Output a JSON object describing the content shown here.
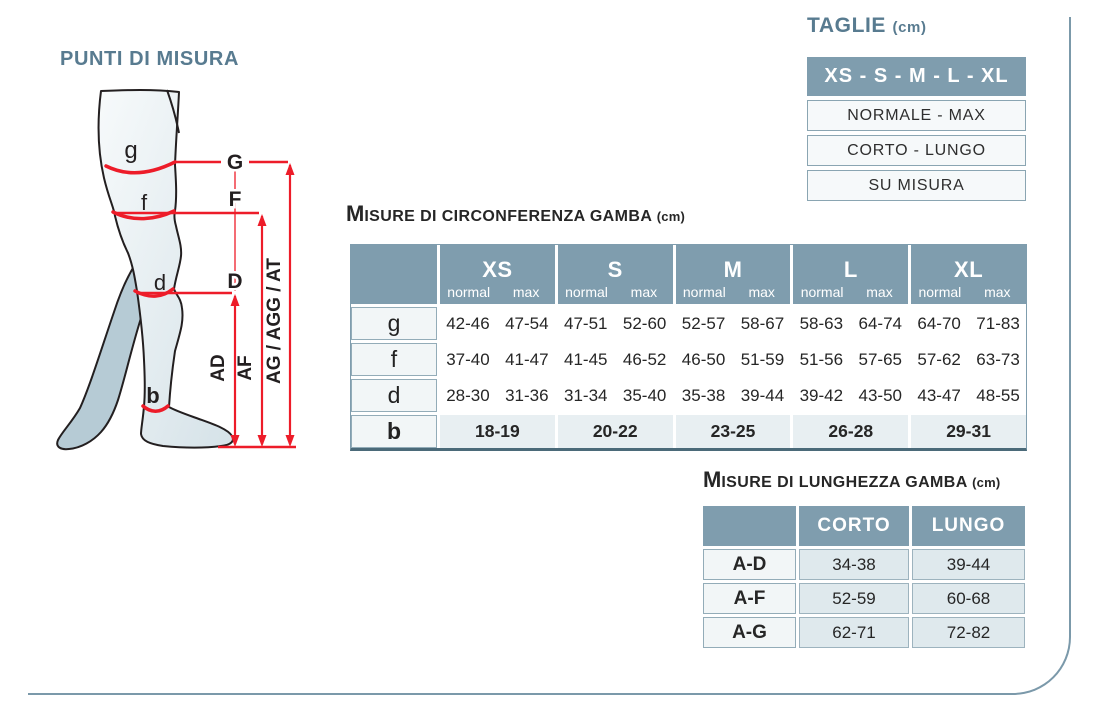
{
  "measure_points": {
    "title": "PUNTI DI MISURA",
    "points": {
      "g": "g",
      "f": "f",
      "d": "d",
      "b": "b"
    },
    "lines": {
      "G": "G",
      "F": "F",
      "D": "D"
    },
    "arrows": {
      "ad": "AD",
      "af": "AF",
      "ag": "AG / AGG / AT"
    }
  },
  "taglie": {
    "title": "TAGLIE",
    "title_unit": "(cm)",
    "sizes_header": "XS - S - M - L - XL",
    "options": [
      "NORMALE - MAX",
      "CORTO - LUNGO",
      "SU MISURA"
    ]
  },
  "circumference": {
    "title_initial": "M",
    "title_rest": "isure di circonferenza gamba",
    "title_unit": "(cm)",
    "sizes": [
      "XS",
      "S",
      "M",
      "L",
      "XL"
    ],
    "subcols": [
      "normal",
      "max"
    ],
    "rows": [
      {
        "label": "g",
        "values": [
          "42-46",
          "47-54",
          "47-51",
          "52-60",
          "52-57",
          "58-67",
          "58-63",
          "64-74",
          "64-70",
          "71-83"
        ]
      },
      {
        "label": "f",
        "values": [
          "37-40",
          "41-47",
          "41-45",
          "46-52",
          "46-50",
          "51-59",
          "51-56",
          "57-65",
          "57-62",
          "63-73"
        ]
      },
      {
        "label": "d",
        "values": [
          "28-30",
          "31-36",
          "31-34",
          "35-40",
          "35-38",
          "39-44",
          "39-42",
          "43-50",
          "43-47",
          "48-55"
        ]
      }
    ],
    "ankle_row": {
      "label": "b",
      "values": [
        "18-19",
        "20-22",
        "23-25",
        "26-28",
        "29-31"
      ]
    }
  },
  "length": {
    "title_initial": "M",
    "title_rest": "isure di lunghezza gamba",
    "title_unit": "(cm)",
    "columns": [
      "CORTO",
      "LUNGO"
    ],
    "rows": [
      {
        "label": "A-D",
        "values": [
          "34-38",
          "39-44"
        ]
      },
      {
        "label": "A-F",
        "values": [
          "52-59",
          "60-68"
        ]
      },
      {
        "label": "A-G",
        "values": [
          "62-71",
          "72-82"
        ]
      }
    ]
  },
  "colors": {
    "accent_blue": "#7f9dae",
    "title_blue": "#587b90",
    "red": "#ed1c29",
    "cell_light": "#e8eff2",
    "text_dark": "#262626"
  }
}
